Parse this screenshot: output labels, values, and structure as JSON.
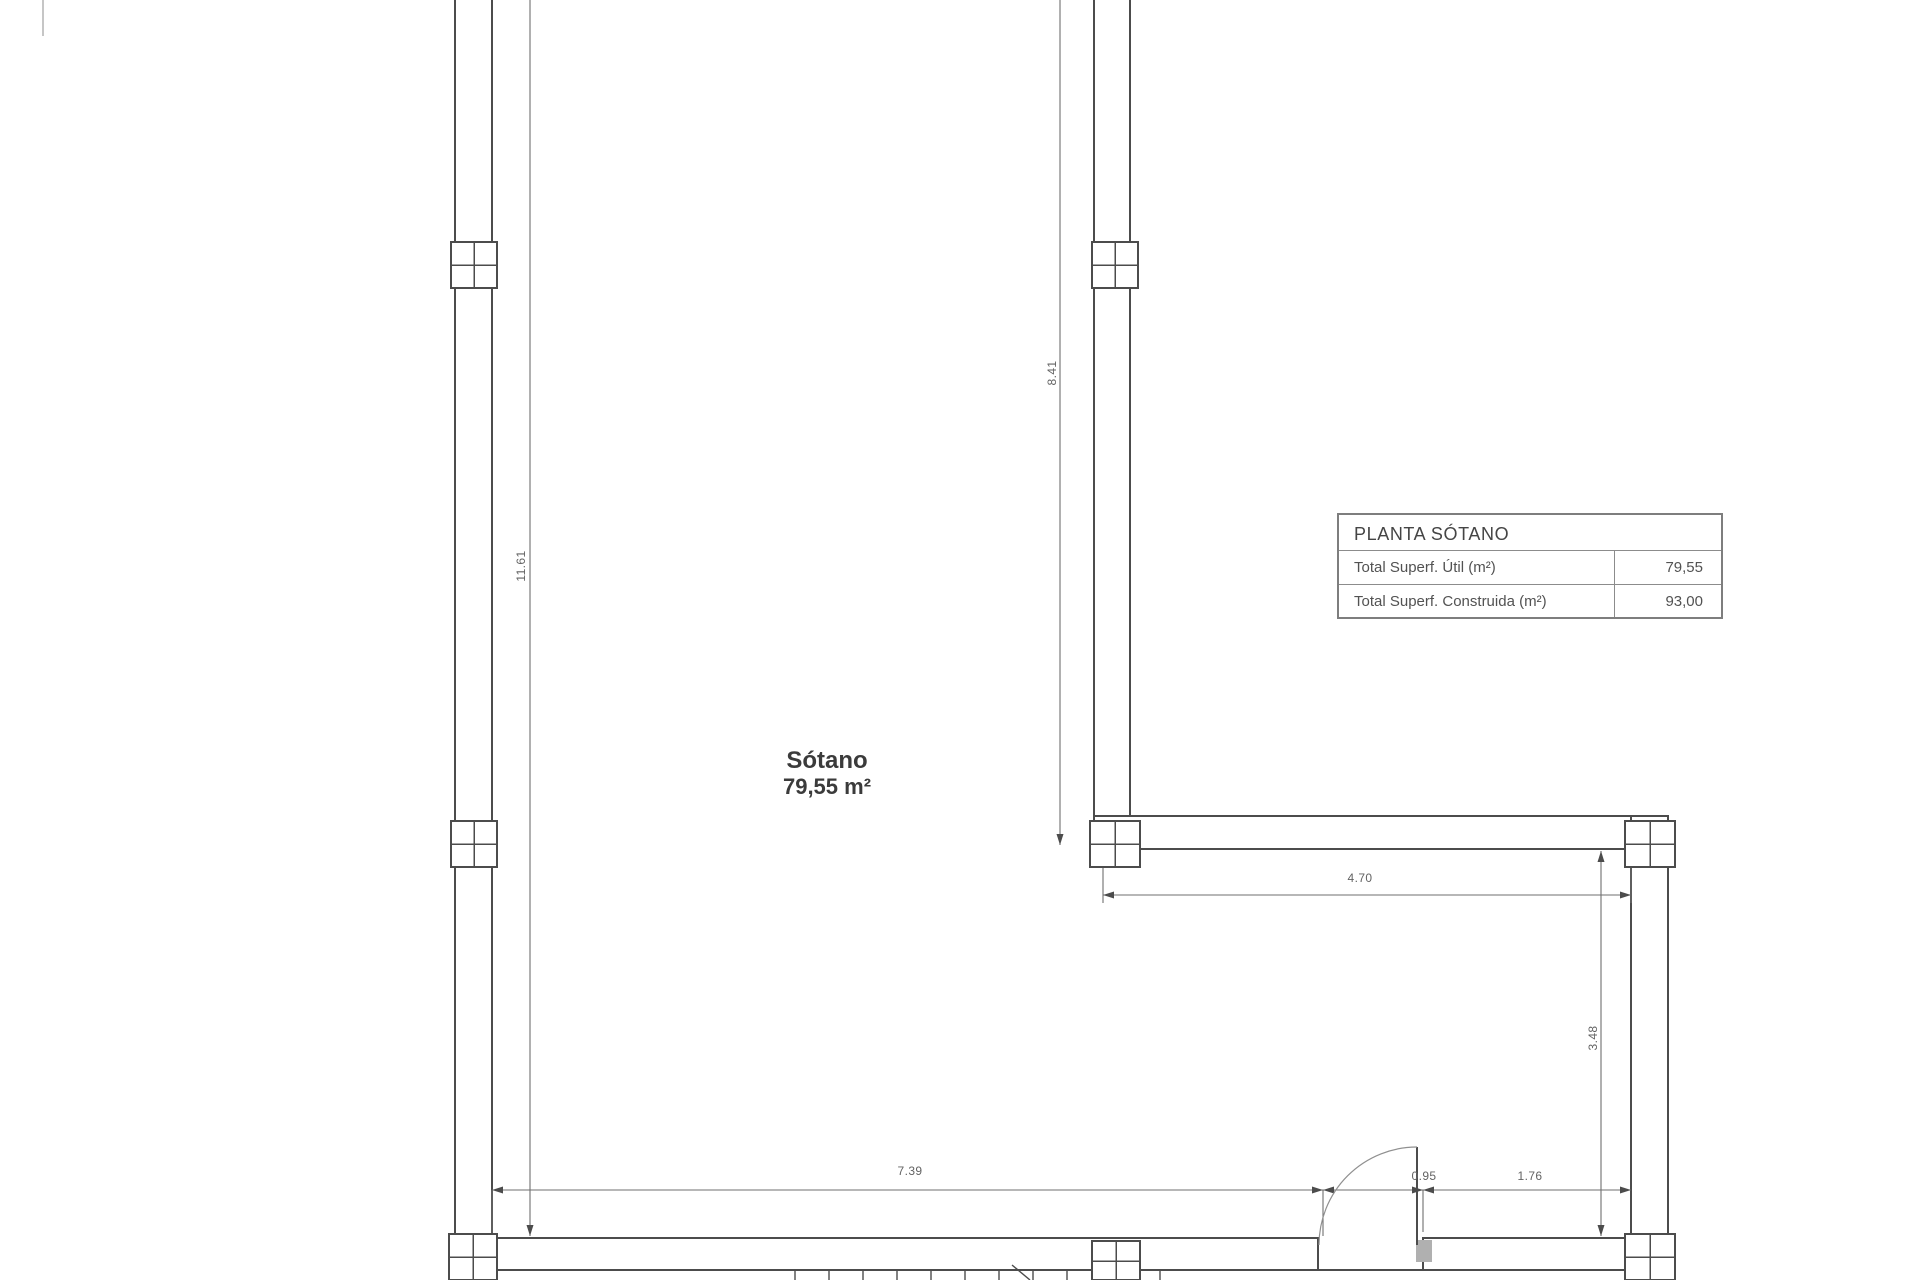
{
  "plan": {
    "room": {
      "name": "Sótano",
      "area": "79,55 m²"
    },
    "legend": {
      "title": "PLANTA SÓTANO",
      "rows": [
        {
          "label": "Total Superf. Útil (m²)",
          "value": "79,55"
        },
        {
          "label": "Total Superf. Construida (m²)",
          "value": "93,00"
        }
      ]
    },
    "dimensions": {
      "left_height": "11.61",
      "mid_height": "8.41",
      "upper_width": "4.70",
      "right_height": "3.48",
      "bottom_width": "7.39",
      "door_width": "0.95",
      "bottom_right_width": "1.76"
    },
    "colors": {
      "wall": "#4c4c4c",
      "dimension": "#6f6f6f",
      "text": "#4a4a4a",
      "background": "#ffffff"
    }
  }
}
